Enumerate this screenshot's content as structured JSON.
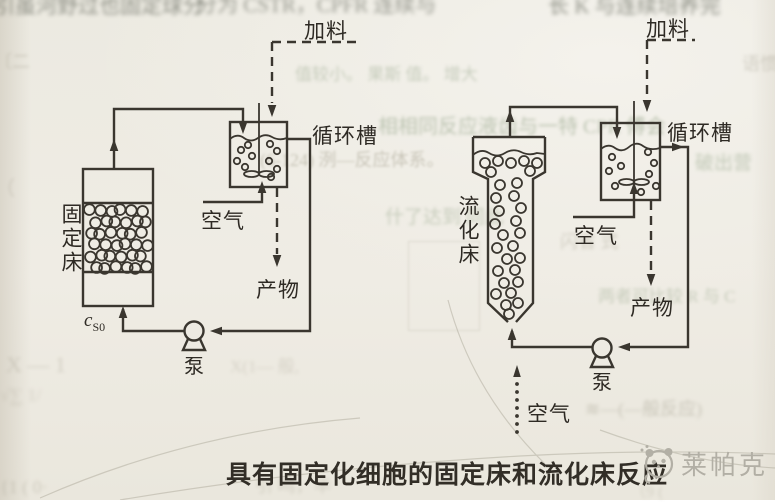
{
  "page": {
    "type": "book-photo-diagram"
  },
  "colors": {
    "paper": "#edeae2",
    "line": "#3a362f",
    "label": "#2e2a24",
    "caption": "#322e27",
    "watermark": "#b2afa5",
    "ghost_green": "#87997b",
    "ghost_gray": "#9b9685"
  },
  "diagram": {
    "left": {
      "feed_label": "加料",
      "tank_label": "循环槽",
      "air_label": "空气",
      "product_label": "产物",
      "pump_label": "泵",
      "bed_label": "固定床",
      "inlet_conc_base": "c",
      "inlet_conc_sub": "S0"
    },
    "right": {
      "feed_label": "加料",
      "tank_label": "循环槽",
      "air_label_tank": "空气",
      "air_label_bottom": "空气",
      "product_label": "产物",
      "pump_label": "泵",
      "bed_label": "流化床"
    },
    "caption": "具有固定化细胞的固定床和流化床反应",
    "watermark_text": "莱帕克",
    "watermark_logo": "panda-logo"
  },
  "ghosts": {
    "top1": "引虽河野过也固定球分",
    "top2": "分为 CSTR，CPFR 连续与",
    "top3": "长 K 与连续培养完",
    "m1": "值较小。 果斯 值。 增大",
    "m2": "相相同反应液齿与一特 CPR 傅会",
    "m2b": "破出营",
    "m3": "(6-124) 洌—反应体系。",
    "m4": "什了达到 同此",
    "m5": "闪省 式",
    "m6": "两者可比较 R 与 C",
    "f1": "X — 1",
    "f2": "√∑ 1/",
    "f3": "X(1— 般,",
    "f4": "≋—(—般反应)",
    "b1": "{1 ( 0·",
    "b2": "引 鸣，毕",
    "b3": "（9 (",
    "l1": "〔二",
    "l2": "（",
    "r1": "语惯"
  }
}
